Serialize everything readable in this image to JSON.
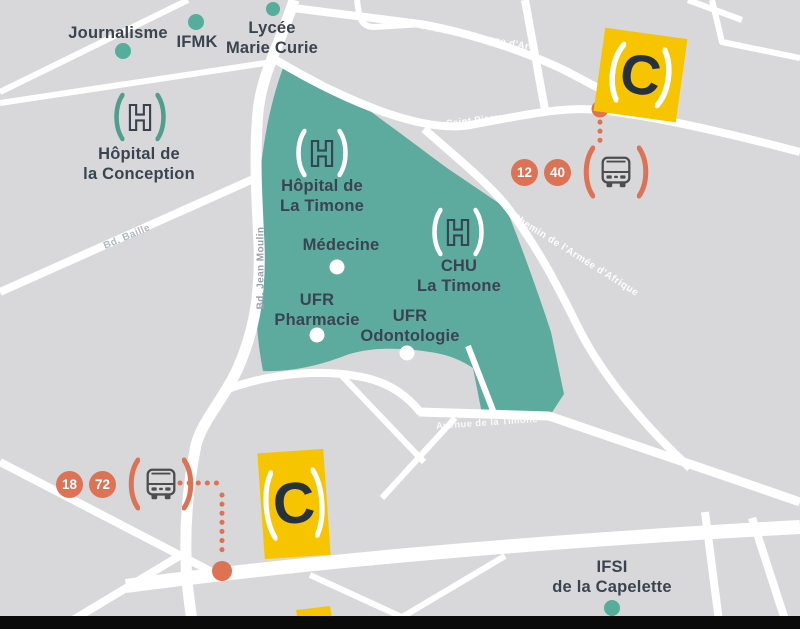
{
  "colors": {
    "background": "#d8d8da",
    "road": "#ffffff",
    "campus_teal": "#5dab9e",
    "marker_teal": "#55ad9c",
    "accent_orange": "#dd7254",
    "logo_yellow": "#f6c500",
    "logo_navy": "#26313f",
    "label_dark": "#3a4450"
  },
  "logo": {
    "letter": "C"
  },
  "pois": {
    "journalisme": {
      "label": "Journalisme"
    },
    "ifmk": {
      "label": "IFMK"
    },
    "lycee_marie_curie": {
      "lines": [
        "Lycée",
        "Marie Curie"
      ]
    },
    "hopital_conception": {
      "lines": [
        "Hôpital de",
        "la Conception"
      ]
    },
    "hopital_timone": {
      "lines": [
        "Hôpital de",
        "La Timone"
      ]
    },
    "medecine": {
      "label": "Médecine"
    },
    "chu_timone": {
      "lines": [
        "CHU",
        "La Timone"
      ]
    },
    "ufr_pharmacie": {
      "lines": [
        "UFR",
        "Pharmacie"
      ]
    },
    "ufr_odontologie": {
      "lines": [
        "UFR",
        "Odontologie"
      ]
    },
    "ifsi_capelette": {
      "lines": [
        "IFSI",
        "de la Capelette"
      ]
    }
  },
  "streets": {
    "boulevard_jeanne_darc": "Boulevard Jeanne d'Arc",
    "rue_saint_pierre": "Rue Saint Pierre",
    "bd_baille": "Bd. Baille",
    "bd_jean_moulin": "Bd. Jean Moulin",
    "chemin_armee_afrique": "Chemin de l'Armée d'Afrique",
    "avenue_timone": "Avenue de la Timone",
    "autoroute_est": "Autoroute Est"
  },
  "bus_stops": {
    "saint_pierre": {
      "routes": [
        "12",
        "40"
      ]
    },
    "capelette": {
      "routes": [
        "18",
        "72"
      ]
    }
  }
}
